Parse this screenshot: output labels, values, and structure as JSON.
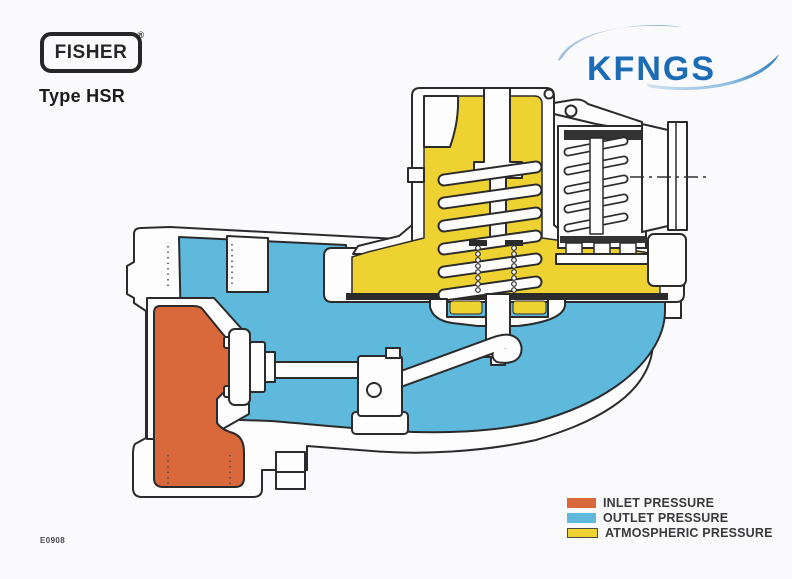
{
  "header": {
    "brand": "FISHER",
    "registered": "®",
    "model": "Type HSR"
  },
  "logo": {
    "text": "KFNGS"
  },
  "figure": {
    "code": "E0908"
  },
  "legend": {
    "items": [
      {
        "label": "INLET PRESSURE"
      },
      {
        "label": "OUTLET PRESSURE"
      },
      {
        "label": "ATMOSPHERIC PRESSURE"
      }
    ]
  },
  "colors": {
    "inlet": "#d9693a",
    "outlet": "#5eb9dd",
    "atmospheric": "#eed231",
    "line": "#2b2b2b",
    "logo_blue": "#1b6cb5"
  }
}
